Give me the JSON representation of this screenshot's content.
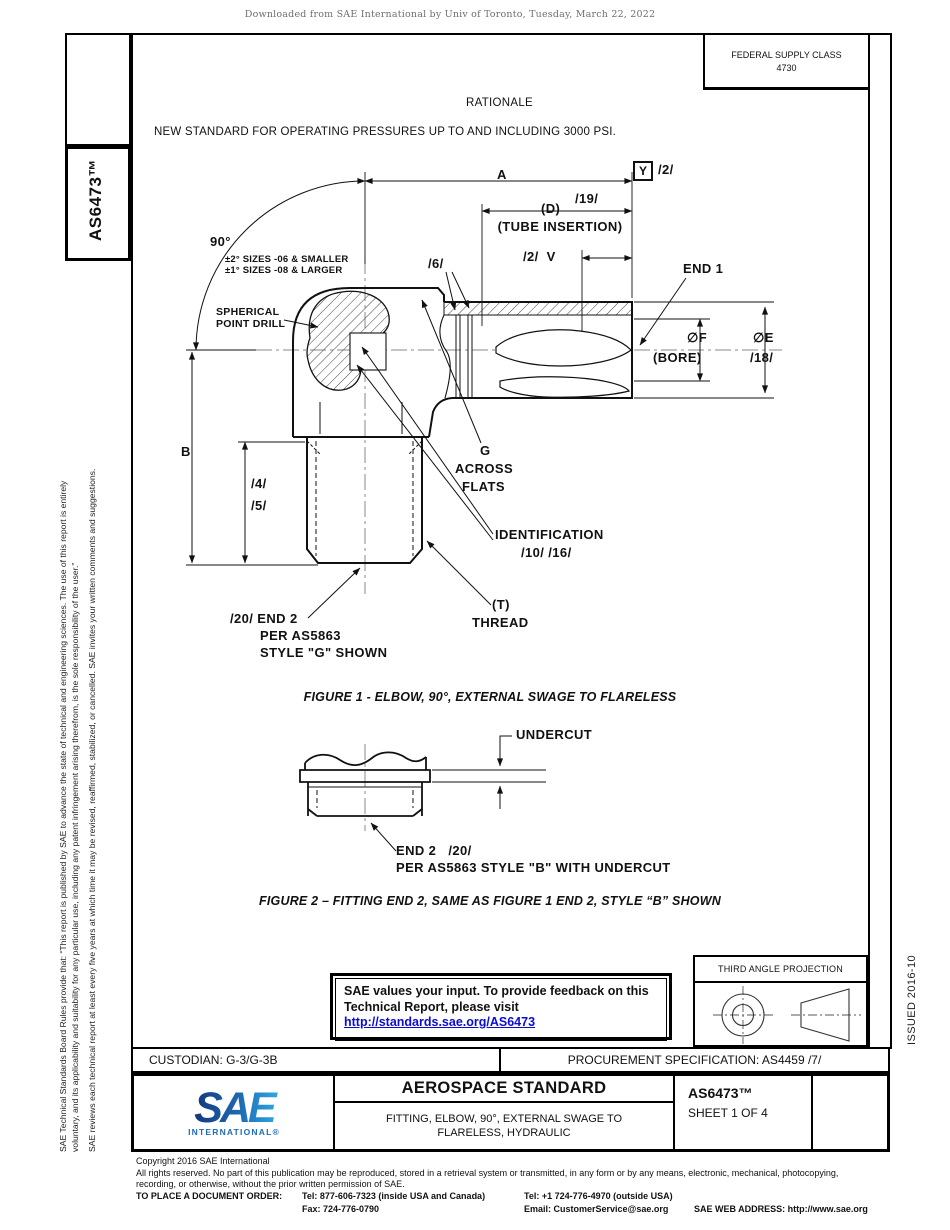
{
  "meta": {
    "header_note": "Downloaded from SAE International by Univ of Toronto, Tuesday, March 22, 2022"
  },
  "top": {
    "fsc_line1": "FEDERAL SUPPLY CLASS",
    "fsc_line2": "4730",
    "rationale": "RATIONALE",
    "new_standard": "NEW STANDARD FOR OPERATING PRESSURES UP TO AND INCLUDING 3000 PSI."
  },
  "left_margin": {
    "doc_number": "AS6473™",
    "legal_line1": "SAE Technical Standards Board Rules provide that: “This report is published by SAE to advance the state of technical and engineering sciences. The use of this report is entirely",
    "legal_line2": "voluntary, and its applicability and suitability for any particular use, including any patent infringement arising therefrom, is the sole responsibility of the user.”",
    "legal_para2": "SAE reviews each technical report at least every five years at which time it may be revised, reaffirmed, stabilized, or cancelled. SAE invites your written comments and suggestions."
  },
  "right_margin": {
    "issued": "ISSUED 2016-10"
  },
  "figure1": {
    "dim_a": "A",
    "datum": "Y",
    "datum_note": "/2/",
    "dim_d": "(D)",
    "note_19": "/19/",
    "tube_insertion": "(TUBE INSERTION)",
    "v_label": "/2/  V",
    "end1": "END 1",
    "angle": "90°",
    "angle_tol_1": "±2° SIZES -06 & SMALLER",
    "angle_tol_2": "±1° SIZES -08 & LARGER",
    "spherical_1": "SPHERICAL",
    "spherical_2": "POINT DRILL",
    "note_6": "/6/",
    "dia_f": "∅F",
    "bore": "(BORE)",
    "dia_e": "∅E",
    "note_18": "/18/",
    "dim_b": "B",
    "note_4": "/4/",
    "note_5": "/5/",
    "g_label": "G",
    "g_across": "ACROSS",
    "g_flats": "FLATS",
    "identification": "IDENTIFICATION",
    "id_notes": "/10/ /16/",
    "thread_t": "(T)",
    "thread": "THREAD",
    "end2_1": "/20/ END 2",
    "end2_2": "PER AS5863",
    "end2_3": "STYLE \"G\" SHOWN",
    "caption": "FIGURE 1 - ELBOW, 90°, EXTERNAL SWAGE TO FLARELESS"
  },
  "figure2": {
    "undercut": "UNDERCUT",
    "end2": "END 2   /20/",
    "end2_note": "PER AS5863 STYLE \"B\" WITH UNDERCUT",
    "caption": "FIGURE 2 – FITTING END 2, SAME AS FIGURE 1 END 2, STYLE “B” SHOWN"
  },
  "feedback": {
    "line1": "SAE values your input. To provide feedback on this",
    "line2": "Technical Report, please visit",
    "link": "http://standards.sae.org/AS6473"
  },
  "projection": {
    "title": "THIRD ANGLE PROJECTION"
  },
  "title_block": {
    "custodian": "CUSTODIAN: G-3/G-3B",
    "procurement": "PROCUREMENT SPECIFICATION: AS4459 /7/",
    "logo_text": "SAE",
    "logo_sub": "INTERNATIONAL®",
    "standard_type": "AEROSPACE STANDARD",
    "title_line1": "FITTING, ELBOW, 90°, EXTERNAL SWAGE TO",
    "title_line2": "FLARELESS, HYDRAULIC",
    "doc_number": "AS6473™",
    "sheet": "SHEET 1 OF 4"
  },
  "footer": {
    "copyright1": "Copyright 2016 SAE International",
    "copyright2": "All rights reserved. No part of this publication may be reproduced, stored in a retrieval system or transmitted, in any form or by any means, electronic, mechanical, photocopying,",
    "copyright3": "recording, or otherwise, without the prior written permission of SAE.",
    "order_label": "TO PLACE A DOCUMENT ORDER:",
    "tel1": "Tel: 877-606-7323 (inside USA and Canada)",
    "tel2": "Tel: +1 724-776-4970 (outside USA)",
    "fax": "Fax: 724-776-0790",
    "email": "Email: CustomerService@sae.org",
    "web": "SAE WEB ADDRESS: http://www.sae.org"
  },
  "colors": {
    "link_blue": "#0b0bd6",
    "logo_blue_dark": "#15377d",
    "logo_blue_light": "#2fa8e1",
    "centerline_gray": "#8a8a8a"
  }
}
